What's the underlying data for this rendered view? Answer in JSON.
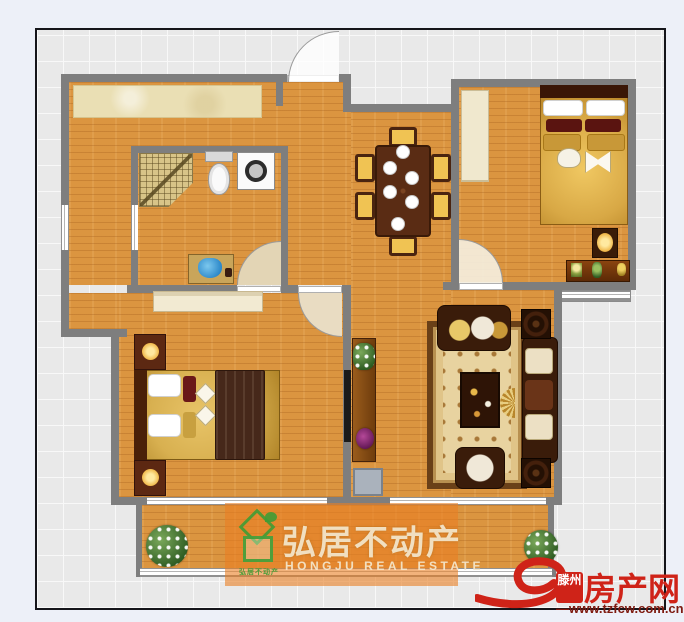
{
  "watermark": {
    "brand_cn": "弘居不动产",
    "brand_en": "HONGJU REAL ESTATE"
  },
  "sitelogo": {
    "city": "滕州",
    "site": "房产网",
    "url": "—www.tzfcw.com.cn"
  },
  "palette": {
    "wall": "#7e7e7e",
    "wood_floor": "#db9540",
    "kitchen_counter": "#eadfb4",
    "grid_bg": "#e9e9e9",
    "brand_red": "#cf2318",
    "brand_green": "#3f9c35",
    "watermark_orange": "rgba(233,126,35,0.6)"
  },
  "floorplan": {
    "rooms": [
      "entry-hall",
      "kitchen",
      "bathroom",
      "dining-area",
      "bedroom",
      "master-bedroom",
      "living-room",
      "balcony"
    ],
    "furniture_icons": [
      "kitchen-counter",
      "shower",
      "toilet",
      "washing-machine",
      "vanity-sink",
      "dining-table",
      "dining-chair",
      "wardrobe",
      "double-bed",
      "nightstand",
      "table-lamp",
      "console-table",
      "dresser",
      "rug",
      "coffee-table",
      "sofa",
      "armchair",
      "end-table",
      "tv",
      "tv-stand",
      "shoe-cabinet",
      "potted-plant",
      "door-swing-arc",
      "window"
    ]
  }
}
